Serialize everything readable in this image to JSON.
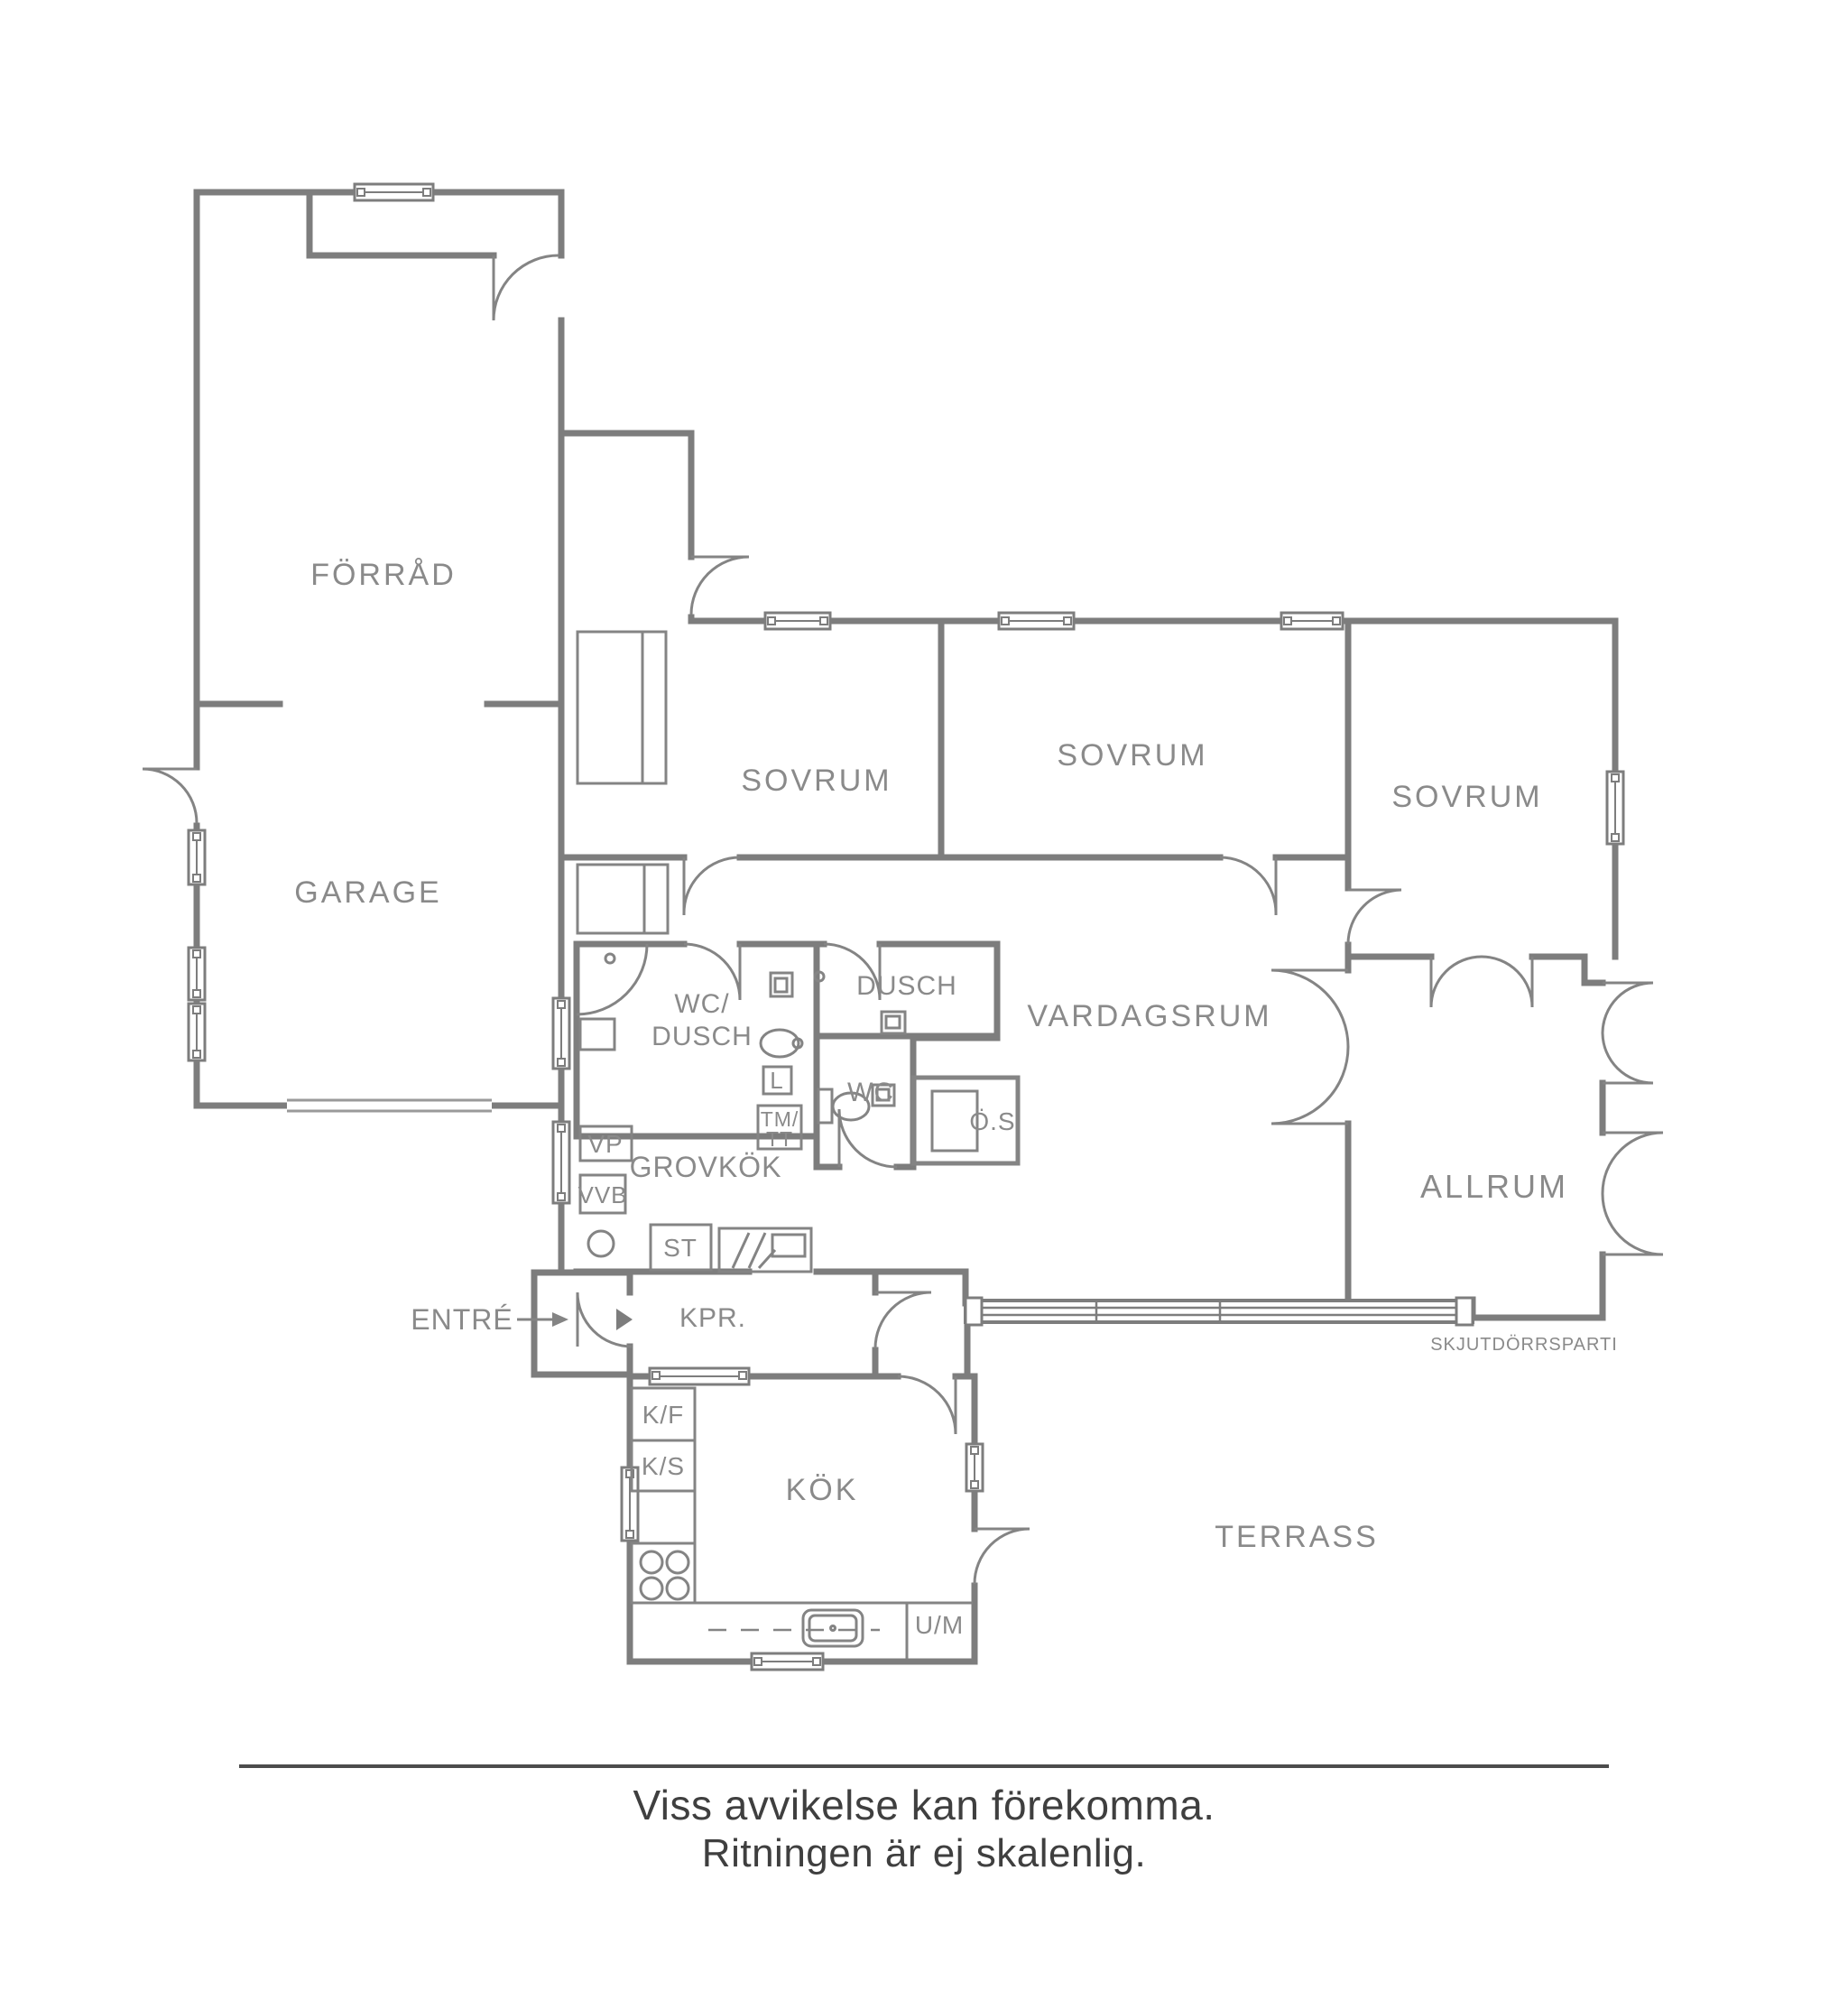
{
  "plan": {
    "labels": {
      "forrad": "FÖRRÅD",
      "garage": "GARAGE",
      "sovrum1": "SOVRUM",
      "sovrum2": "SOVRUM",
      "sovrum3": "SOVRUM",
      "wc_dusch_line1": "WC/",
      "wc_dusch_line2": "DUSCH",
      "dusch": "DUSCH",
      "wc": "WC",
      "l": "L",
      "tm": "TM/",
      "tt": "TT",
      "os": "Ö.S",
      "vardagsrum": "VARDAGSRUM",
      "allrum": "ALLRUM",
      "skjutdorrsparti": "SKJUTDÖRRSPARTI",
      "grovkok": "GROVKÖK",
      "vp": "VP",
      "vvb": "VVB",
      "st": "ST",
      "entre": "ENTRÉ",
      "kpr": "KPR.",
      "kf": "K/F",
      "ks": "K/S",
      "kok": "KÖK",
      "um": "U/M",
      "terrass": "TERRASS"
    },
    "footer": {
      "line1": "Viss avvikelse kan förekomma.",
      "line2": "Ritningen är ej skalenlig."
    },
    "colors": {
      "wall": "#7d7d7d",
      "fixture": "#848484",
      "label": "#8a8a8a",
      "divider": "#4c4c4c",
      "footer_text": "#3f3f3f",
      "background": "#ffffff"
    }
  }
}
